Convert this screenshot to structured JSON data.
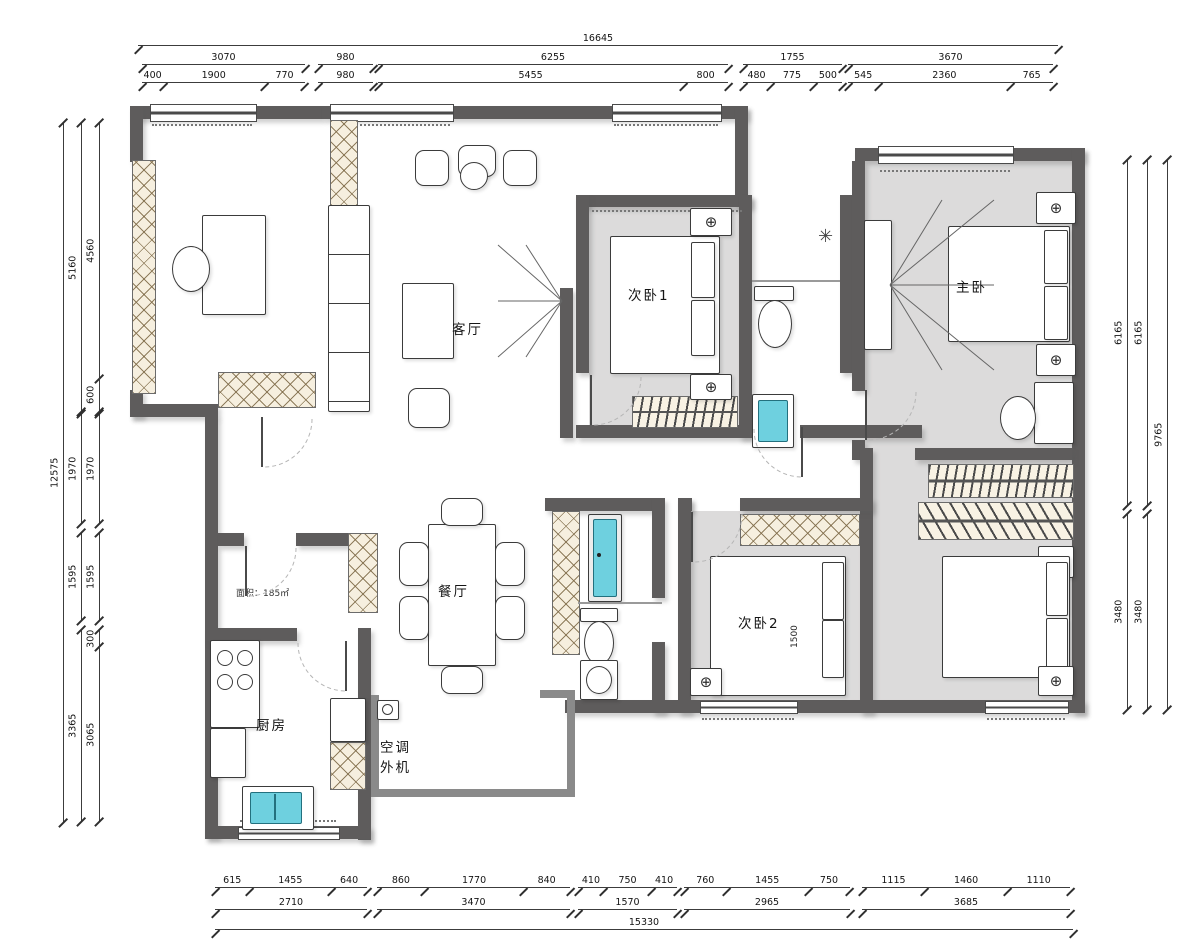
{
  "rooms": {
    "living": "客厅",
    "bedroom1": "次卧1",
    "master": "主卧",
    "bedroom2": "次卧2",
    "dining": "餐厅",
    "kitchen": "厨房",
    "ac1": "空调",
    "ac2": "外机"
  },
  "area_note": "面积：185㎡",
  "inline": {
    "bed2_width": "1500"
  },
  "icons": {
    "light": "⊕",
    "shower": "✳"
  },
  "colors": {
    "wall": "#5e5c5c",
    "floor_gray": "#dcdbdb",
    "accent_teal": "#6ed0df",
    "hatch_cream": "#f6efdf"
  },
  "chains": {
    "t1": [
      16645
    ],
    "t2a": [
      3070
    ],
    "t2b": [
      980
    ],
    "t2c": [
      6255
    ],
    "t2d": [
      1755
    ],
    "t2e": [
      3670
    ],
    "t3a": [
      400,
      1900,
      770
    ],
    "t3b": [
      980
    ],
    "t3c": [
      5455,
      800
    ],
    "t3d": [
      480,
      775,
      500
    ],
    "t3e": [
      545,
      2360,
      765
    ],
    "l1": [
      12575
    ],
    "l2a": [
      5160
    ],
    "l2b": [
      1970
    ],
    "l2c": [
      1595
    ],
    "l2d": [
      3365
    ],
    "l3a": [
      4560,
      600
    ],
    "l3b": [
      1970
    ],
    "l3c": [
      1595
    ],
    "l3d": [
      300,
      3065
    ],
    "r1a": [
      6165
    ],
    "r1b": [
      3480
    ],
    "r2a": [
      6165
    ],
    "r2b": [
      3480
    ],
    "r3": [
      9765
    ],
    "b1a": [
      615,
      1455,
      640
    ],
    "b1b": [
      860,
      1770,
      840
    ],
    "b1c": [
      410,
      750,
      410
    ],
    "b1d": [
      760,
      1455,
      750
    ],
    "b1e": [
      1115,
      1460,
      1110
    ],
    "b2a": [
      2710
    ],
    "b2b": [
      3470
    ],
    "b2c": [
      1570
    ],
    "b2d": [
      2965
    ],
    "b2e": [
      3685
    ],
    "b3": [
      15330
    ]
  }
}
